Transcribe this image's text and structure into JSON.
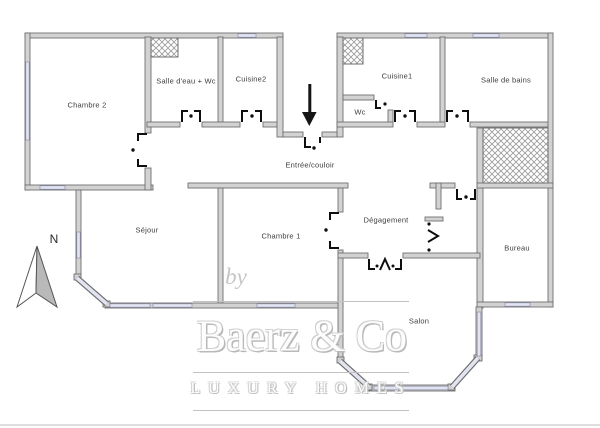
{
  "rooms": {
    "chambre2": {
      "label": "Chambre 2"
    },
    "salle_deau_wc": {
      "label": "Salle d'eau + Wc"
    },
    "cuisine2": {
      "label": "Cuisine2"
    },
    "cuisine1": {
      "label": "Cuisine1"
    },
    "wc": {
      "label": "Wc"
    },
    "salle_de_bains": {
      "label": "Salle de bains"
    },
    "entree_couloir": {
      "label": "Entrée/couloir"
    },
    "sejour": {
      "label": "Séjour"
    },
    "chambre1": {
      "label": "Chambre 1"
    },
    "degagement": {
      "label": "Dégagement"
    },
    "bureau": {
      "label": "Bureau"
    },
    "salon": {
      "label": "Salon"
    }
  },
  "compass": {
    "north_label": "N"
  },
  "watermark": {
    "prefix": "by",
    "brand": "Baerz & Co",
    "tagline": "LUXURY HOMES"
  },
  "colors": {
    "background": "#ffffff",
    "wall_fill": "#d2d2d2",
    "wall_stroke": "#6f6f6f",
    "window_fill": "#e2e4f2",
    "window_stroke": "#8e90ad",
    "door_marks": "#0f0f0f",
    "label_text": "#3d3d3d",
    "watermark_gray": "#c6c6c6",
    "compass_fill": "#b9b9b9"
  }
}
